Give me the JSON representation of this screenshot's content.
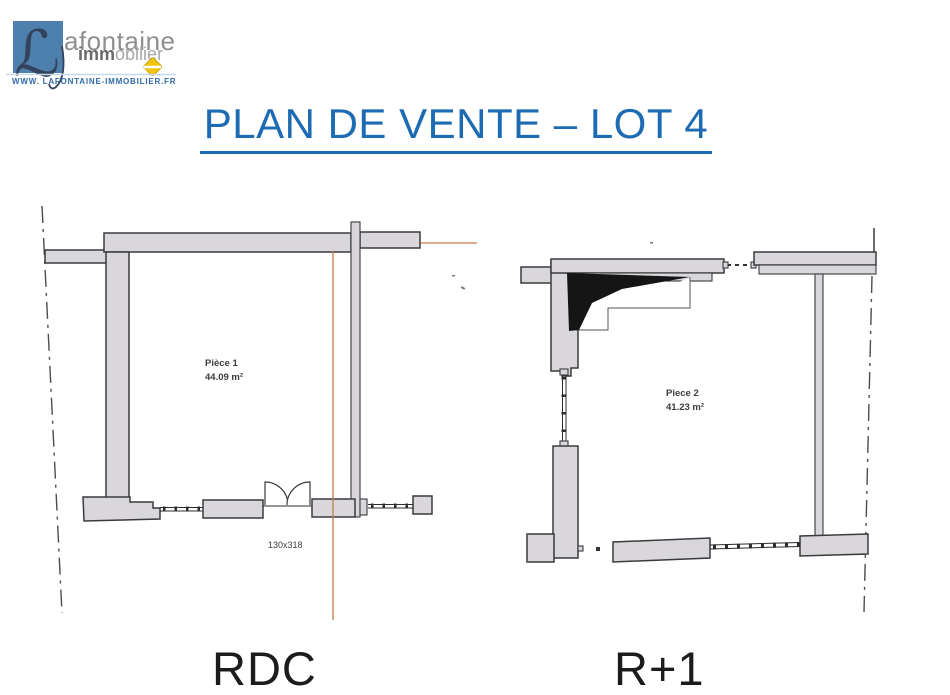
{
  "logo": {
    "monogram": "ℒ",
    "brand_line1": "afontaine",
    "brand_line2_bold": "imm",
    "brand_line2_light": "obilier",
    "website": "WWW. LAFONTAINE-IMMOBILIER.FR",
    "square_color": "#4d80ac",
    "diamond_color": "#f2c50e",
    "website_color": "#2f6ba8"
  },
  "title": {
    "text": "PLAN DE VENTE – LOT 4",
    "color": "#1d6cb3"
  },
  "plans": [
    {
      "floor_label": "RDC",
      "room_label": "Pièce 1",
      "room_area": "44.09 m²",
      "door_dimension": "130x318"
    },
    {
      "floor_label": "R+1",
      "room_label": "Piece 2",
      "room_area": "41.23 m²"
    }
  ],
  "drawing_colors": {
    "wall_fill": "#d9d7db",
    "wall_stroke": "#3a3a3c",
    "survey_line_orange": "#c67b47",
    "boundary_dashdot": "#4d4d4d",
    "stair_fill": "#151515"
  }
}
